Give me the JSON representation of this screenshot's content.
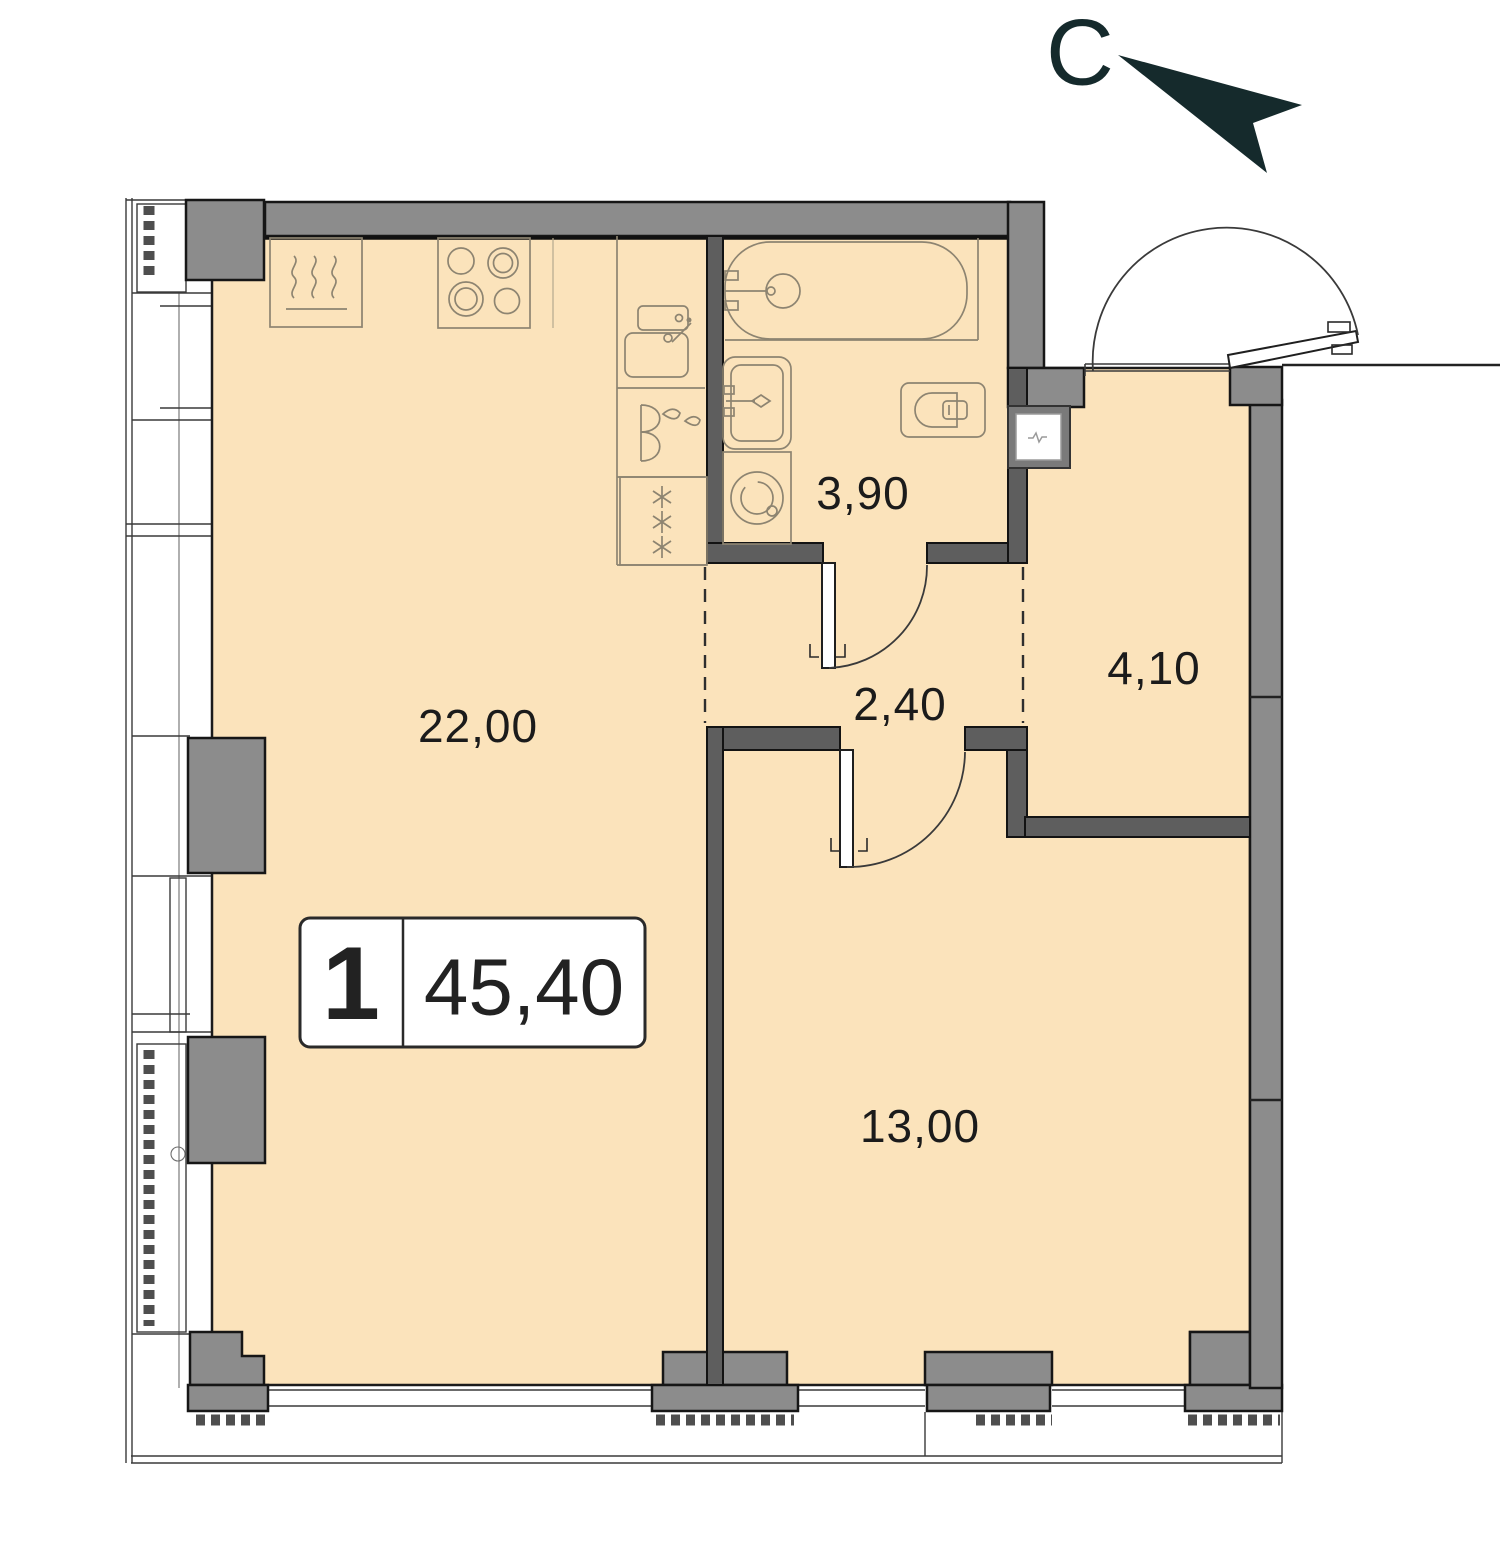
{
  "compass": {
    "north_letter": "С"
  },
  "badge": {
    "rooms_count": "1",
    "total_area": "45,40"
  },
  "rooms": {
    "living_kitchen": {
      "area": "22,00"
    },
    "bathroom": {
      "area": "3,90"
    },
    "hallway": {
      "area": "2,40"
    },
    "entry": {
      "area": "4,10"
    },
    "bedroom": {
      "area": "13,00"
    }
  },
  "colors": {
    "floor": "#FBE3BB",
    "wall_gray": "#8C8C8C",
    "wall_interior": "#5E5E5E",
    "outline": "#161616",
    "fixture_line": "#8D8471",
    "compass_dark": "#152A2C"
  }
}
